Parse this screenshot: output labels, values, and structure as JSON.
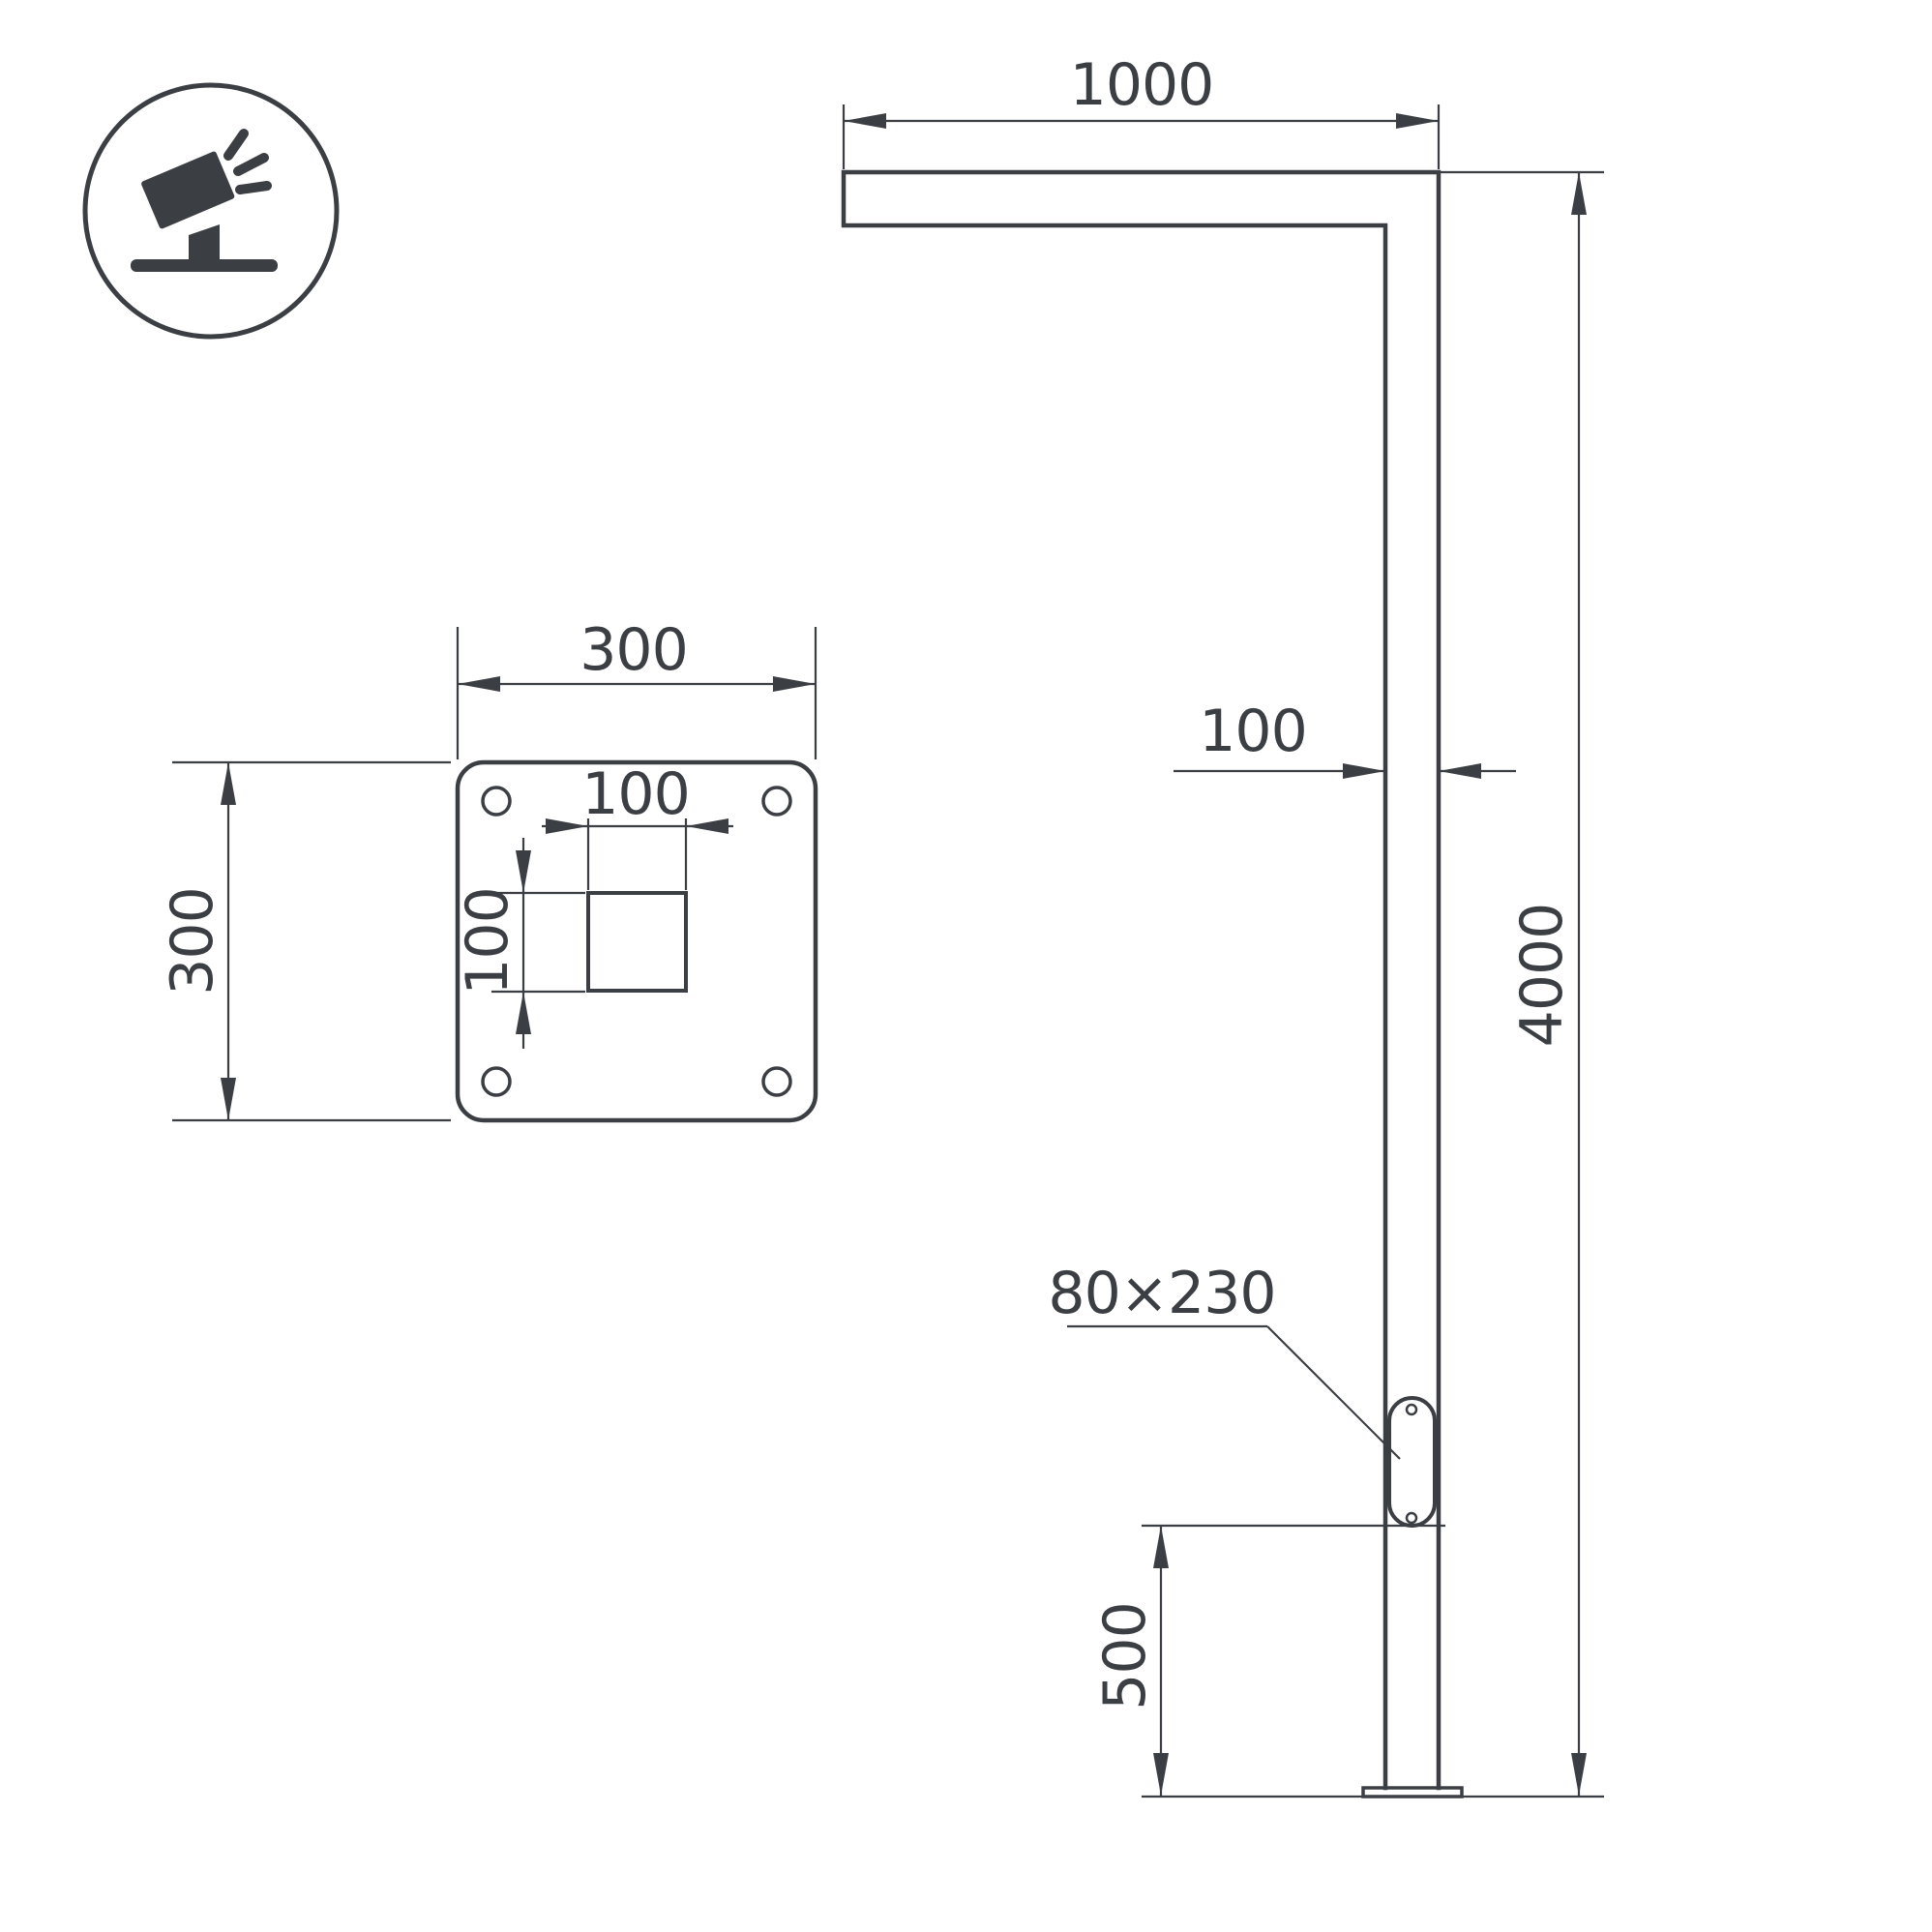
{
  "colors": {
    "background": "#ffffff",
    "line": "#3b3e42"
  },
  "icon": {
    "name": "tilted-floodlight"
  },
  "plate_top_view": {
    "plate_width": "300",
    "plate_height": "300",
    "socket_width": "100",
    "socket_height": "100"
  },
  "pole_side_view": {
    "arm_length": "1000",
    "pole_width": "100",
    "pole_height": "4000",
    "hatch_bottom_offset": "500",
    "hatch_size": "80×230"
  }
}
